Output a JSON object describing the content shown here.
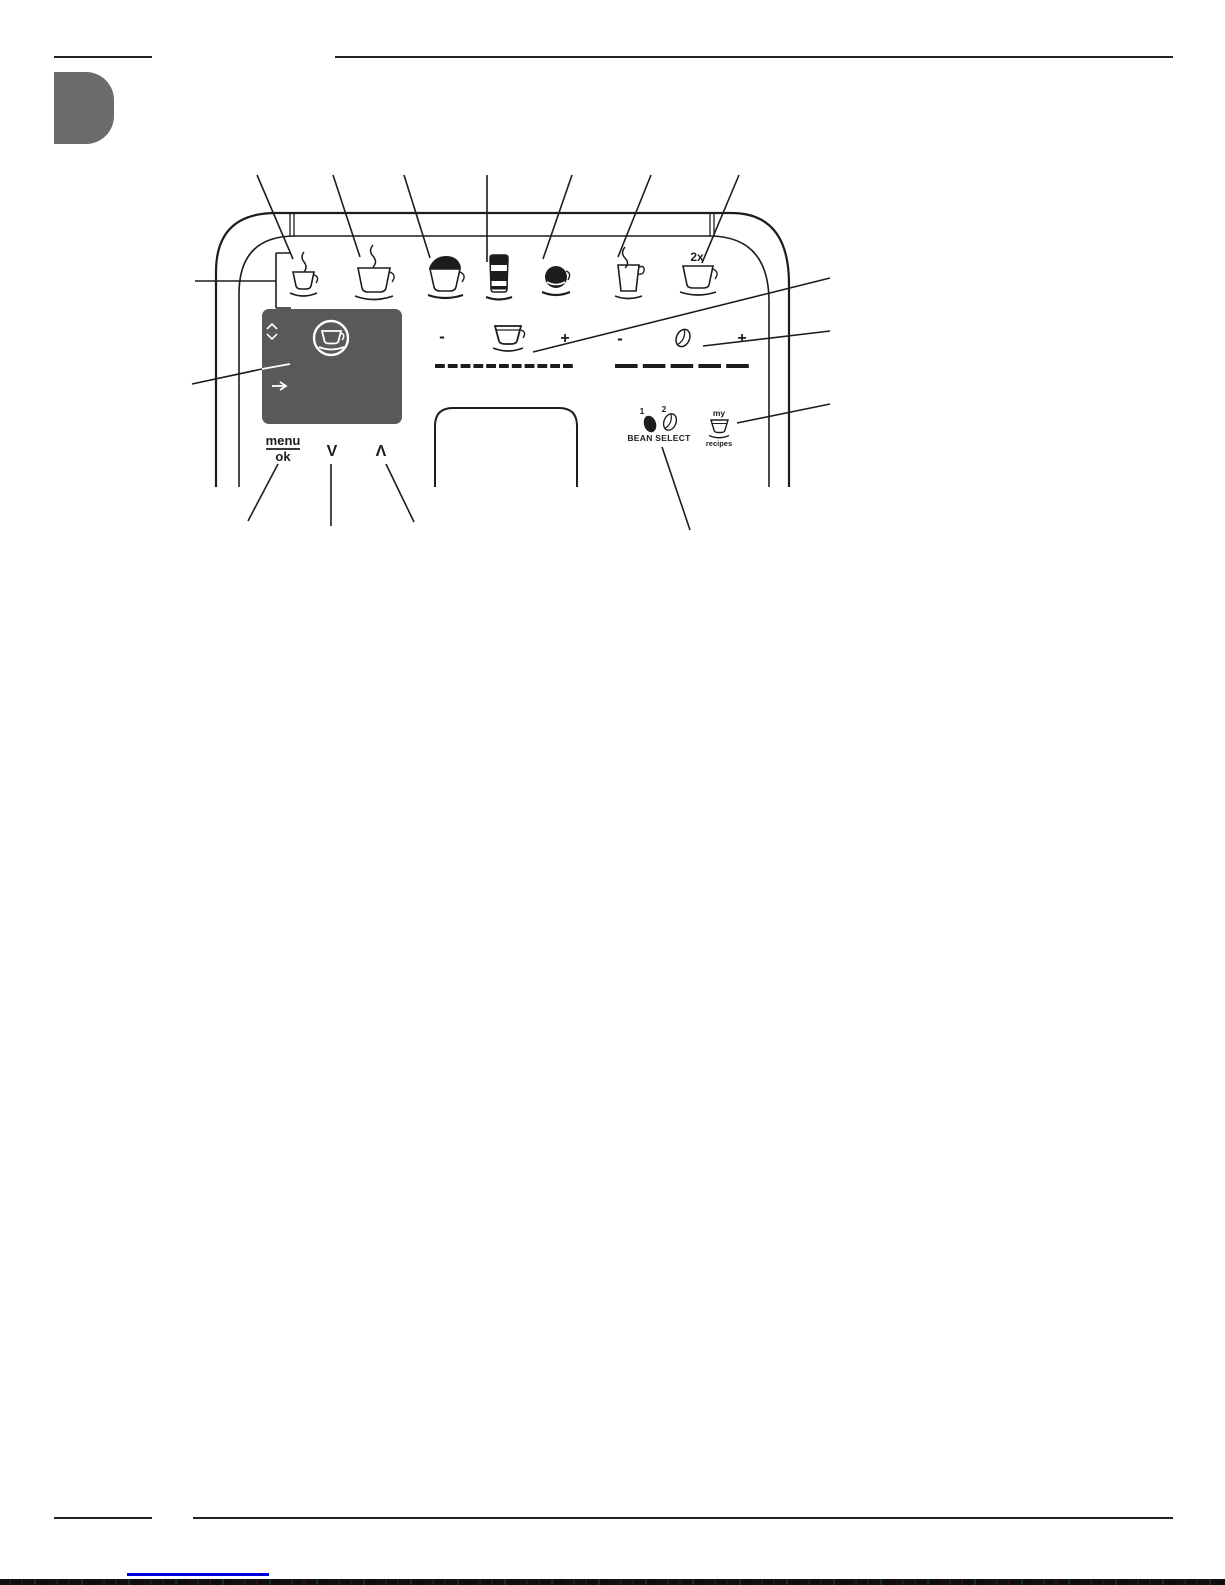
{
  "figure": {
    "drink_buttons": [
      {
        "name": "espresso"
      },
      {
        "name": "coffee"
      },
      {
        "name": "cappuccino"
      },
      {
        "name": "latte-macchiato"
      },
      {
        "name": "cafe-creme"
      },
      {
        "name": "hot-water"
      },
      {
        "name": "double-espresso",
        "label": "2x"
      }
    ],
    "display": {
      "icons": [
        "scroll-chevrons",
        "cup-in-circle",
        "forward-arrow"
      ]
    },
    "menu_ok_button": {
      "top_label": "menu",
      "bottom_label": "ok"
    },
    "down_button_label": "V",
    "up_button_label": "Λ",
    "coffee_volume_slider": {
      "minus_label": "-",
      "plus_label": "+",
      "icon": "cup-icon"
    },
    "coffee_strength_slider": {
      "minus_label": "-",
      "plus_label": "+",
      "icon": "bean-icon"
    },
    "bean_select": {
      "bean1_label": "1",
      "bean2_label": "2",
      "label": "BEAN SELECT"
    },
    "my_recipes_button": {
      "top_label": "my",
      "bottom_label": "recipes"
    }
  },
  "colors": {
    "line": "#1d1d1d",
    "display_bg": "#59595b",
    "tab_bg": "#6a6b6d",
    "link": "#0000dd"
  }
}
